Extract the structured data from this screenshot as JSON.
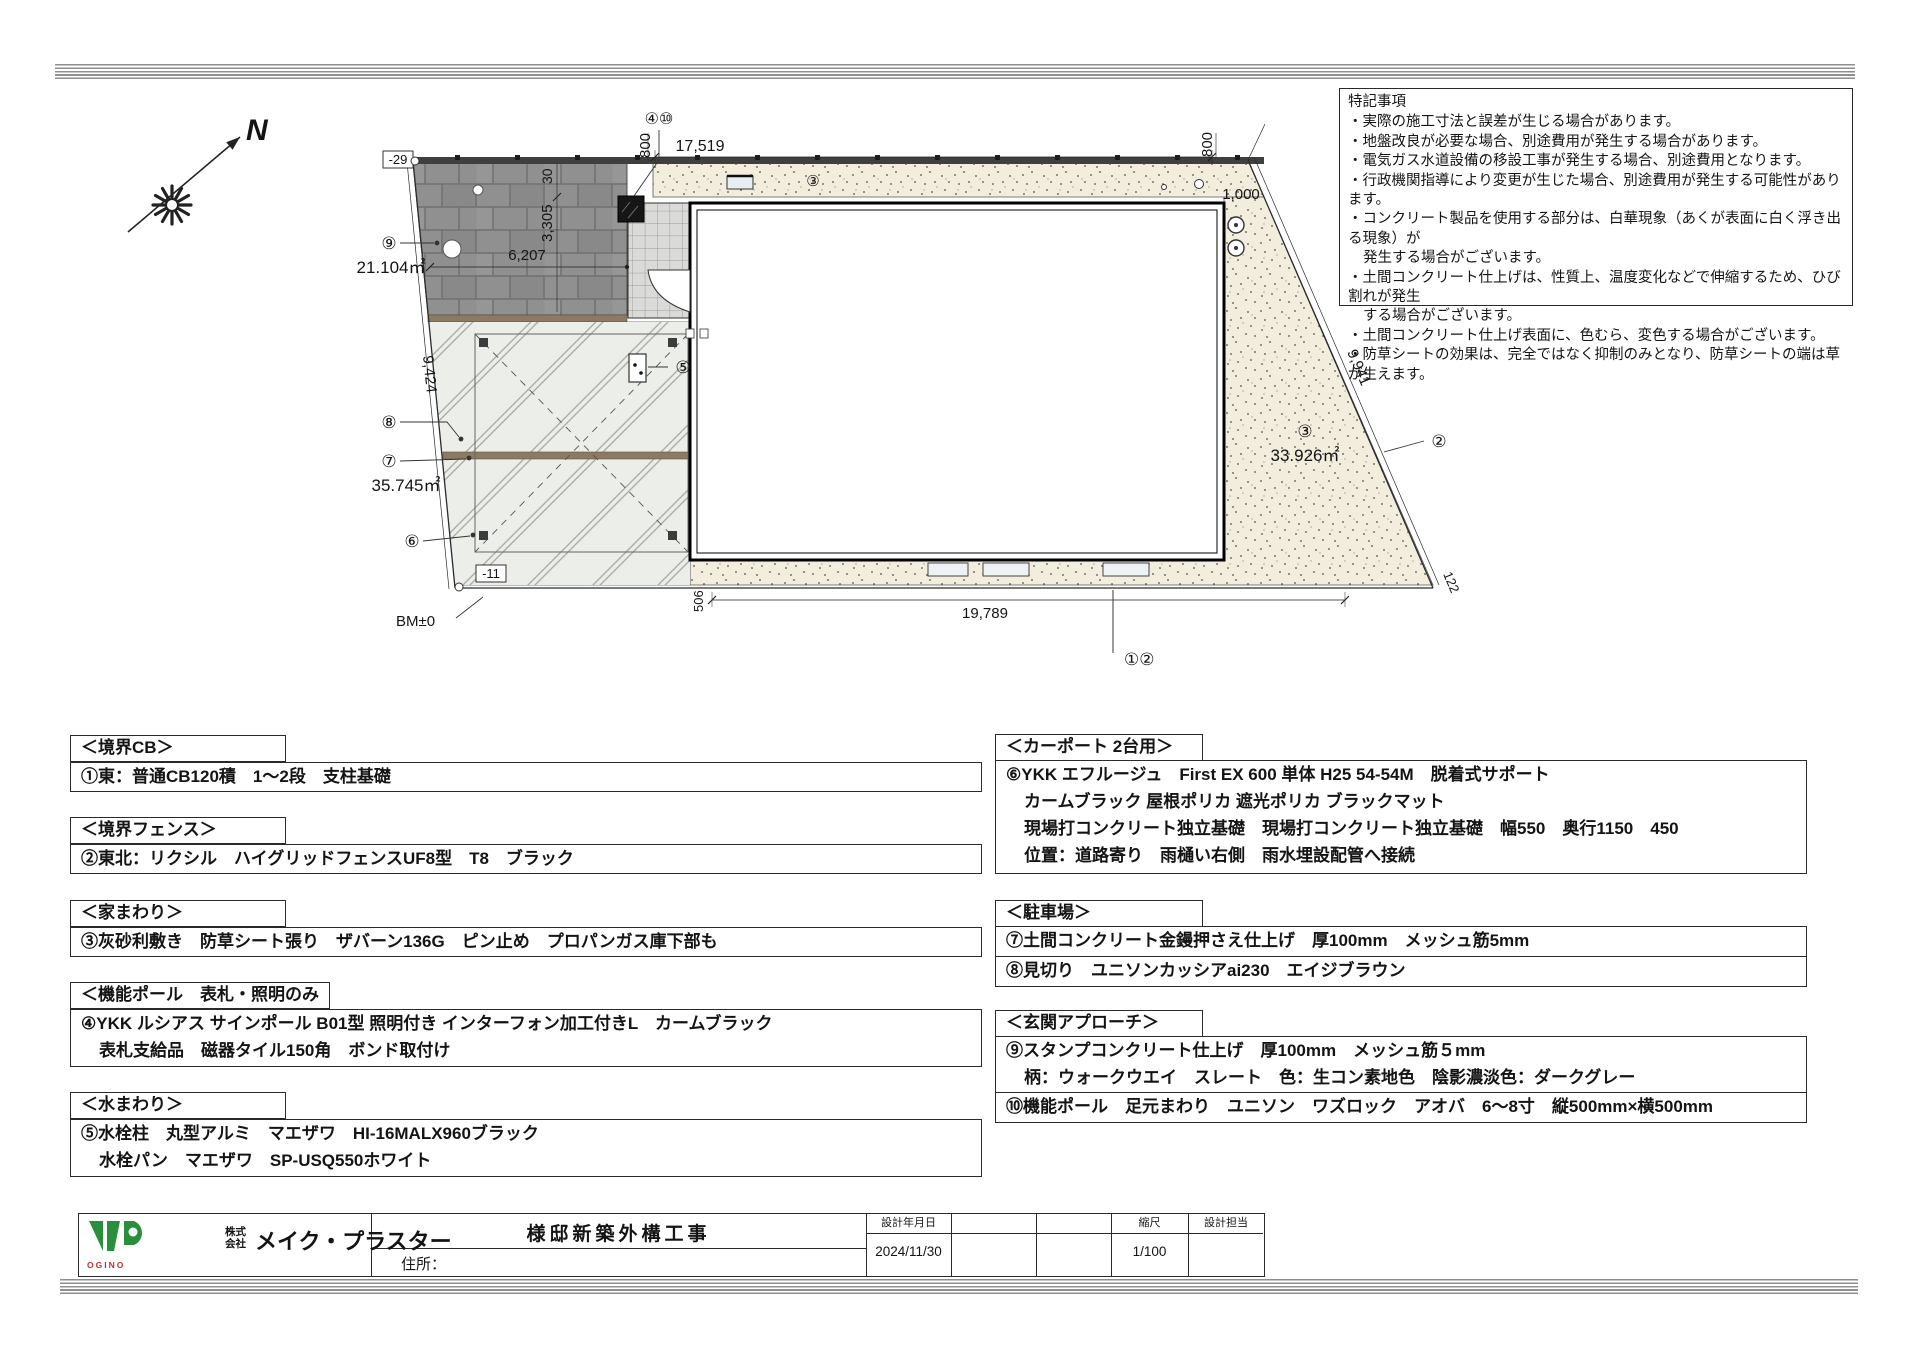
{
  "notes": {
    "title": "特記事項",
    "lines": [
      "・実際の施工寸法と誤差が生じる場合があります。",
      "・地盤改良が必要な場合、別途費用が発生する場合があります。",
      "・電気ガス水道設備の移設工事が発生する場合、別途費用となります。",
      "・行政機関指導により変更が生じた場合、別途費用が発生する可能性があります。",
      "・コンクリート製品を使用する部分は、白華現象（あくが表面に白く浮き出る現象）が",
      "発生する場合がございます。",
      "・土間コンクリート仕上げは、性質上、温度変化などで伸縮するため、ひび割れが発生",
      "する場合がございます。",
      "・土間コンクリート仕上げ表面に、色むら、変色する場合がございます。",
      "・防草シートの効果は、完全ではなく抑制のみとなり、防草シートの端は草が生えます。"
    ]
  },
  "plan": {
    "labels": {
      "north_n": "N",
      "lv_top": "-29",
      "lv_bottom": "-11",
      "bm": "BM±0",
      "dim_17519": "17,519",
      "dim_19789": "19,789",
      "dim_6207": "6,207",
      "dim_800_top": "800",
      "dim_800_right": "800",
      "dim_1000": "1,000",
      "dim_30": "30",
      "dim_3305": "3,305",
      "dim_9424": "9,424",
      "dim_9941": "9,941",
      "dim_506": "506",
      "dim_122": "122",
      "ref_functionpole": "④⑩",
      "ref_approach": "⑨",
      "area_approach": "21.104㎡",
      "ref_edging": "⑧",
      "ref_drive": "⑦",
      "area_drive": "35.745㎡",
      "ref_carport": "⑥",
      "ref_tap": "⑤",
      "ref_gravel_top": "③",
      "ref_gravel_right": "③",
      "area_gravel": "33.926㎡",
      "ref_fence": "②",
      "ref_boundary": "①②"
    }
  },
  "specs": {
    "left": [
      {
        "header": "＜境界CB＞",
        "rows": [
          [
            "①東：普通CB120積　1～2段　支柱基礎"
          ]
        ]
      },
      {
        "header": "＜境界フェンス＞",
        "rows": [
          [
            "②東北：リクシル　ハイグリッドフェンスUF8型　T8　ブラック"
          ]
        ]
      },
      {
        "header": "＜家まわり＞",
        "rows": [
          [
            "③灰砂利敷き　防草シート張り　ザバーン136G　ピン止め　プロパンガス庫下部も"
          ]
        ]
      },
      {
        "header": "＜機能ポール　表札・照明のみ　＞",
        "rows": [
          [
            "④YKK ルシアス サインポール B01型 照明付き インターフォン加工付きL　カームブラック",
            "表札支給品　磁器タイル150角　ボンド取付け"
          ]
        ]
      },
      {
        "header": "＜水まわり＞",
        "rows": [
          [
            "⑤水栓柱　丸型アルミ　マエザワ　HI-16MALX960ブラック",
            "水栓パン　マエザワ　SP-USQ550ホワイト"
          ]
        ]
      }
    ],
    "right": [
      {
        "header": "＜カーポート 2台用＞",
        "rows": [
          [
            "⑥YKK エフルージュ　First EX 600 単体 H25 54-54M　脱着式サポート",
            "カームブラック 屋根ポリカ 遮光ポリカ ブラックマット",
            "現場打コンクリート独立基礎　現場打コンクリート独立基礎　幅550　奥行1150　450",
            "位置：道路寄り　雨樋い右側　雨水埋設配管へ接続"
          ]
        ]
      },
      {
        "header": "＜駐車場＞",
        "rows": [
          [
            "⑦土間コンクリート金鏝押さえ仕上げ　厚100mm　メッシュ筋5mm"
          ],
          [
            "⑧見切り　ユニソンカッシアai230　エイジブラウン"
          ]
        ]
      },
      {
        "header": "＜玄関アプローチ＞",
        "rows": [
          [
            "⑨スタンプコンクリート仕上げ　厚100mm　メッシュ筋５mm",
            "柄：ウォークウエイ　スレート　色：生コン素地色　陰影濃淡色：ダークグレー"
          ],
          [
            "⑩機能ポール　足元まわり　ユニソン　ワズロック　アオバ　6～8寸　縦500mm×横500mm"
          ]
        ]
      }
    ]
  },
  "titleblock": {
    "logo_mark": "MP",
    "logo_sub": "OGINO",
    "company_prefix_top": "株式",
    "company_prefix_bottom": "会社",
    "company_name": "メイク・プラスター",
    "project_title": "様邸新築外構工事",
    "address_label": "住所：",
    "date_label": "設計年月日",
    "date_value": "2024/11/30",
    "scale_label": "縮尺",
    "scale_value": "1/100",
    "designer_label": "設計担当"
  },
  "colors": {
    "logo_green": "#2a8f3c",
    "logo_red": "#c03030",
    "paver_gray": "#909090",
    "gravel_beige": "#f2eddd",
    "edging_brown": "#8d7a62"
  }
}
